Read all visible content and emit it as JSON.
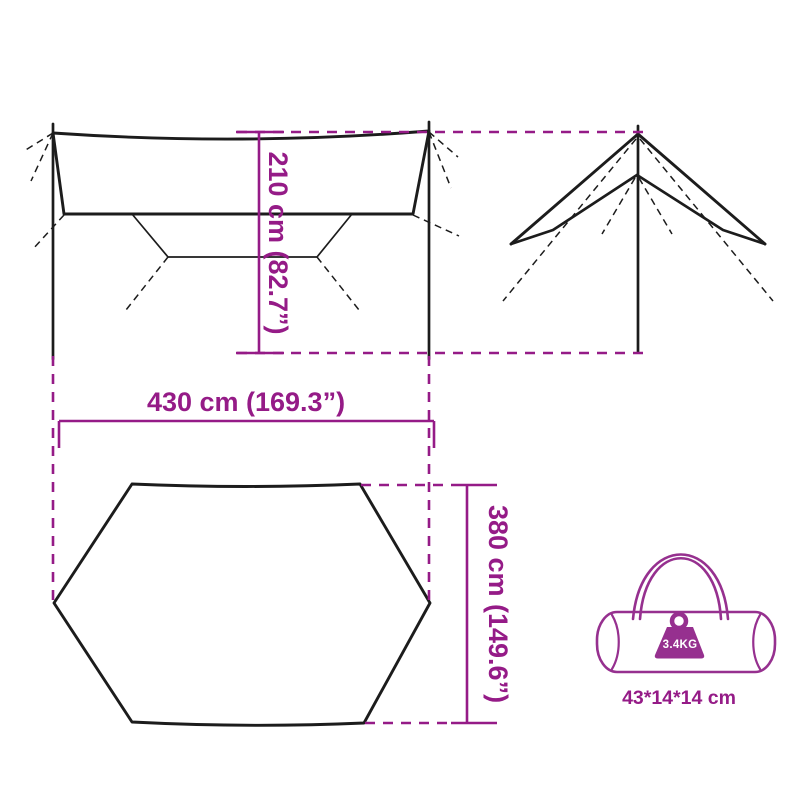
{
  "colors": {
    "outline": "#1c1c1c",
    "dimension": "#951b87",
    "bag": "#96308f",
    "weight_text": "#ffffff",
    "background": "#ffffff"
  },
  "labels": {
    "height": "210 cm (82.7”)",
    "width": "430 cm (169.3”)",
    "depth": "380 cm (149.6”)",
    "bag_weight": "3.4KG",
    "bag_size": "43*14*14 cm"
  }
}
